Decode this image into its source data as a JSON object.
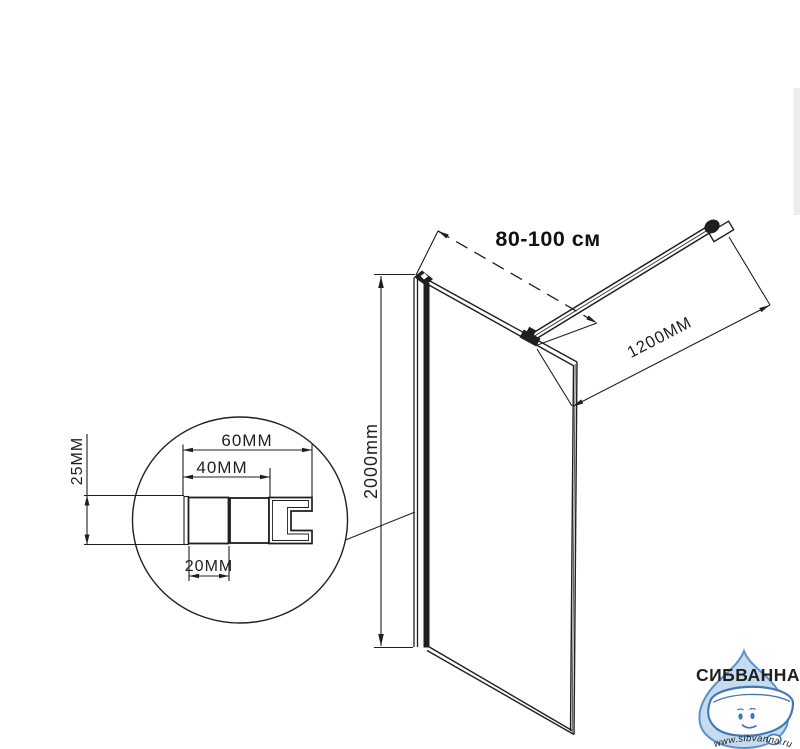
{
  "diagram": {
    "line_color": "#1f1f1f",
    "main_view": {
      "panel_width_label": "80-100 см",
      "panel_height_label": "2000mm",
      "support_bar_length_label": "1200MM"
    },
    "detail_view": {
      "total_width_label": "60MM",
      "wall_profile_width_label": "40MM",
      "inner_box_width_label": "20MM",
      "profile_height_label": "25MM"
    }
  },
  "watermark": {
    "brand": "СИБВАННА",
    "url": "www.sibvanna.ru",
    "brand_color": "#4576b8",
    "drop_fill": "#c5dbee",
    "drop_stroke": "#5d92c9",
    "url_color": "#8fb6de"
  }
}
